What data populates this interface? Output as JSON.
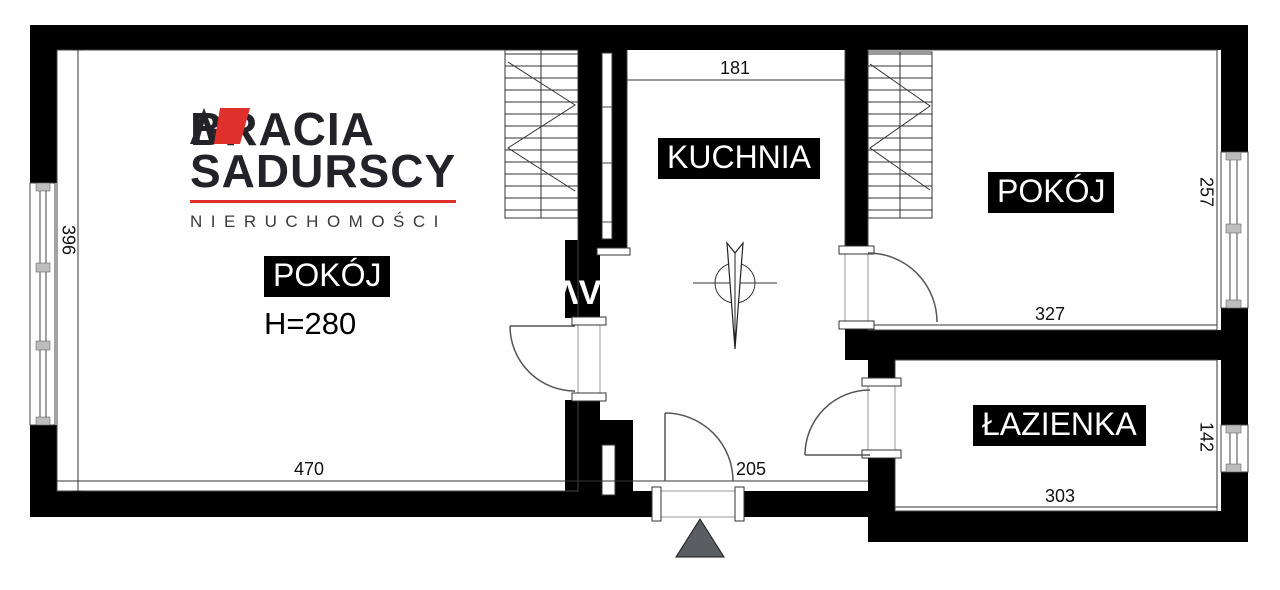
{
  "logo": {
    "line1": "BRACIA",
    "line2": "SADURSCY",
    "tagline": "NIERUCHOMOŚCI"
  },
  "watermark": "ΛV",
  "rooms": {
    "room1": {
      "label": "POKÓJ",
      "ceiling_height": "H=280"
    },
    "kitchen": {
      "label": "KUCHNIA"
    },
    "room2": {
      "label": "POKÓJ"
    },
    "bathroom": {
      "label": "ŁAZIENKA"
    }
  },
  "dimensions": {
    "room1_width": "470",
    "room1_height": "396",
    "kitchen_width": "181",
    "hall_width": "205",
    "room2_width": "327",
    "room2_height": "257",
    "bathroom_width": "303",
    "bathroom_height": "142"
  },
  "colors": {
    "wall": "#000000",
    "logo_red": "#e0302c",
    "logo_text": "#232228",
    "entrance_marker": "#5a5e62"
  }
}
